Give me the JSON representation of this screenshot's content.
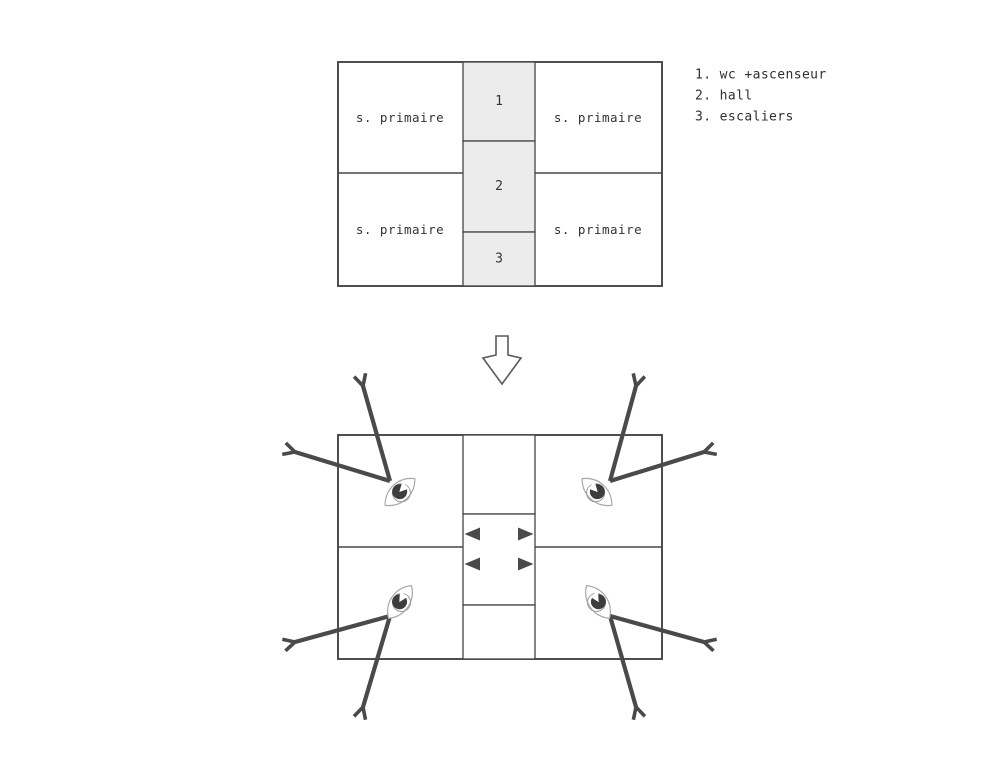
{
  "colors": {
    "background": "#ffffff",
    "plan_line": "#454545",
    "arrow": "#4a4a4a",
    "shade": "#ececec",
    "eye_outline": "#a9a9a9",
    "pupil": "#3d3d3d",
    "text": "#333333"
  },
  "upper_plan": {
    "room_labels": {
      "top_left": "s. primaire",
      "top_right": "s. primaire",
      "bottom_left": "s. primaire",
      "bottom_right": "s. primaire"
    },
    "cell_numbers": {
      "c1": "1",
      "c2": "2",
      "c3": "3"
    }
  },
  "legend": {
    "items": [
      {
        "text": "1. wc +ascenseur"
      },
      {
        "text": "2. hall"
      },
      {
        "text": "3. escaliers"
      }
    ]
  }
}
